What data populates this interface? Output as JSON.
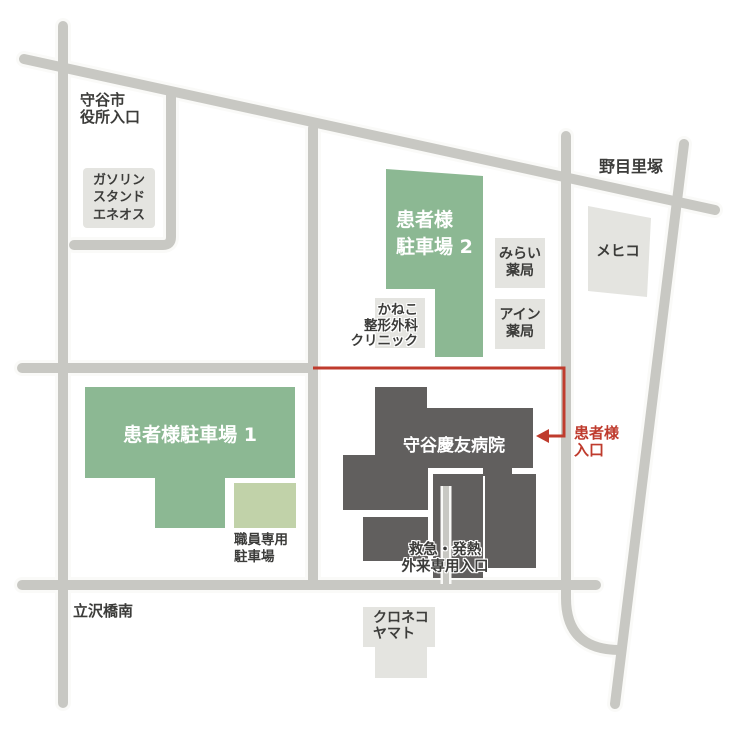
{
  "colors": {
    "background": "#ffffff",
    "road": "#c8c8c3",
    "road_casing": "#fafaf8",
    "parking_green": "#8cb893",
    "staff_green": "#c1d2a9",
    "building_gray": "#615f5e",
    "box_gray": "#e4e4e0",
    "text_dark": "#3c3c3a",
    "text_white": "#ffffff",
    "route_red": "#bf3b2d"
  },
  "places": {
    "city_hall": {
      "line1": "守谷市",
      "line2": "役所入口"
    },
    "gas_station": {
      "line1": "ガソリン",
      "line2": "スタンド",
      "line3": "エネオス"
    },
    "parking2": {
      "line1": "患者様",
      "line2": "駐車場 2"
    },
    "kaneko_clinic": {
      "line1": "かねこ",
      "line2": "整形外科",
      "line3": "クリニック"
    },
    "mirai_pharmacy": {
      "line1": "みらい",
      "line2": "薬局"
    },
    "ain_pharmacy": {
      "line1": "アイン",
      "line2": "薬局"
    },
    "mehico": {
      "name": "メヒコ"
    },
    "nomesato": {
      "name": "野目里塚"
    },
    "parking1": {
      "name": "患者様駐車場 1"
    },
    "staff_parking": {
      "line1": "職員専用",
      "line2": "駐車場"
    },
    "hospital": {
      "name": "守谷慶友病院"
    },
    "patient_entrance": {
      "line1": "患者様",
      "line2": "入口"
    },
    "emergency_entrance": {
      "line1": "救急・発熱",
      "line2": "外来専用入口"
    },
    "kuroneko_yamato": {
      "line1": "クロネコ",
      "line2": "ヤマト"
    },
    "tatsuzawa": {
      "name": "立沢橋南"
    }
  }
}
